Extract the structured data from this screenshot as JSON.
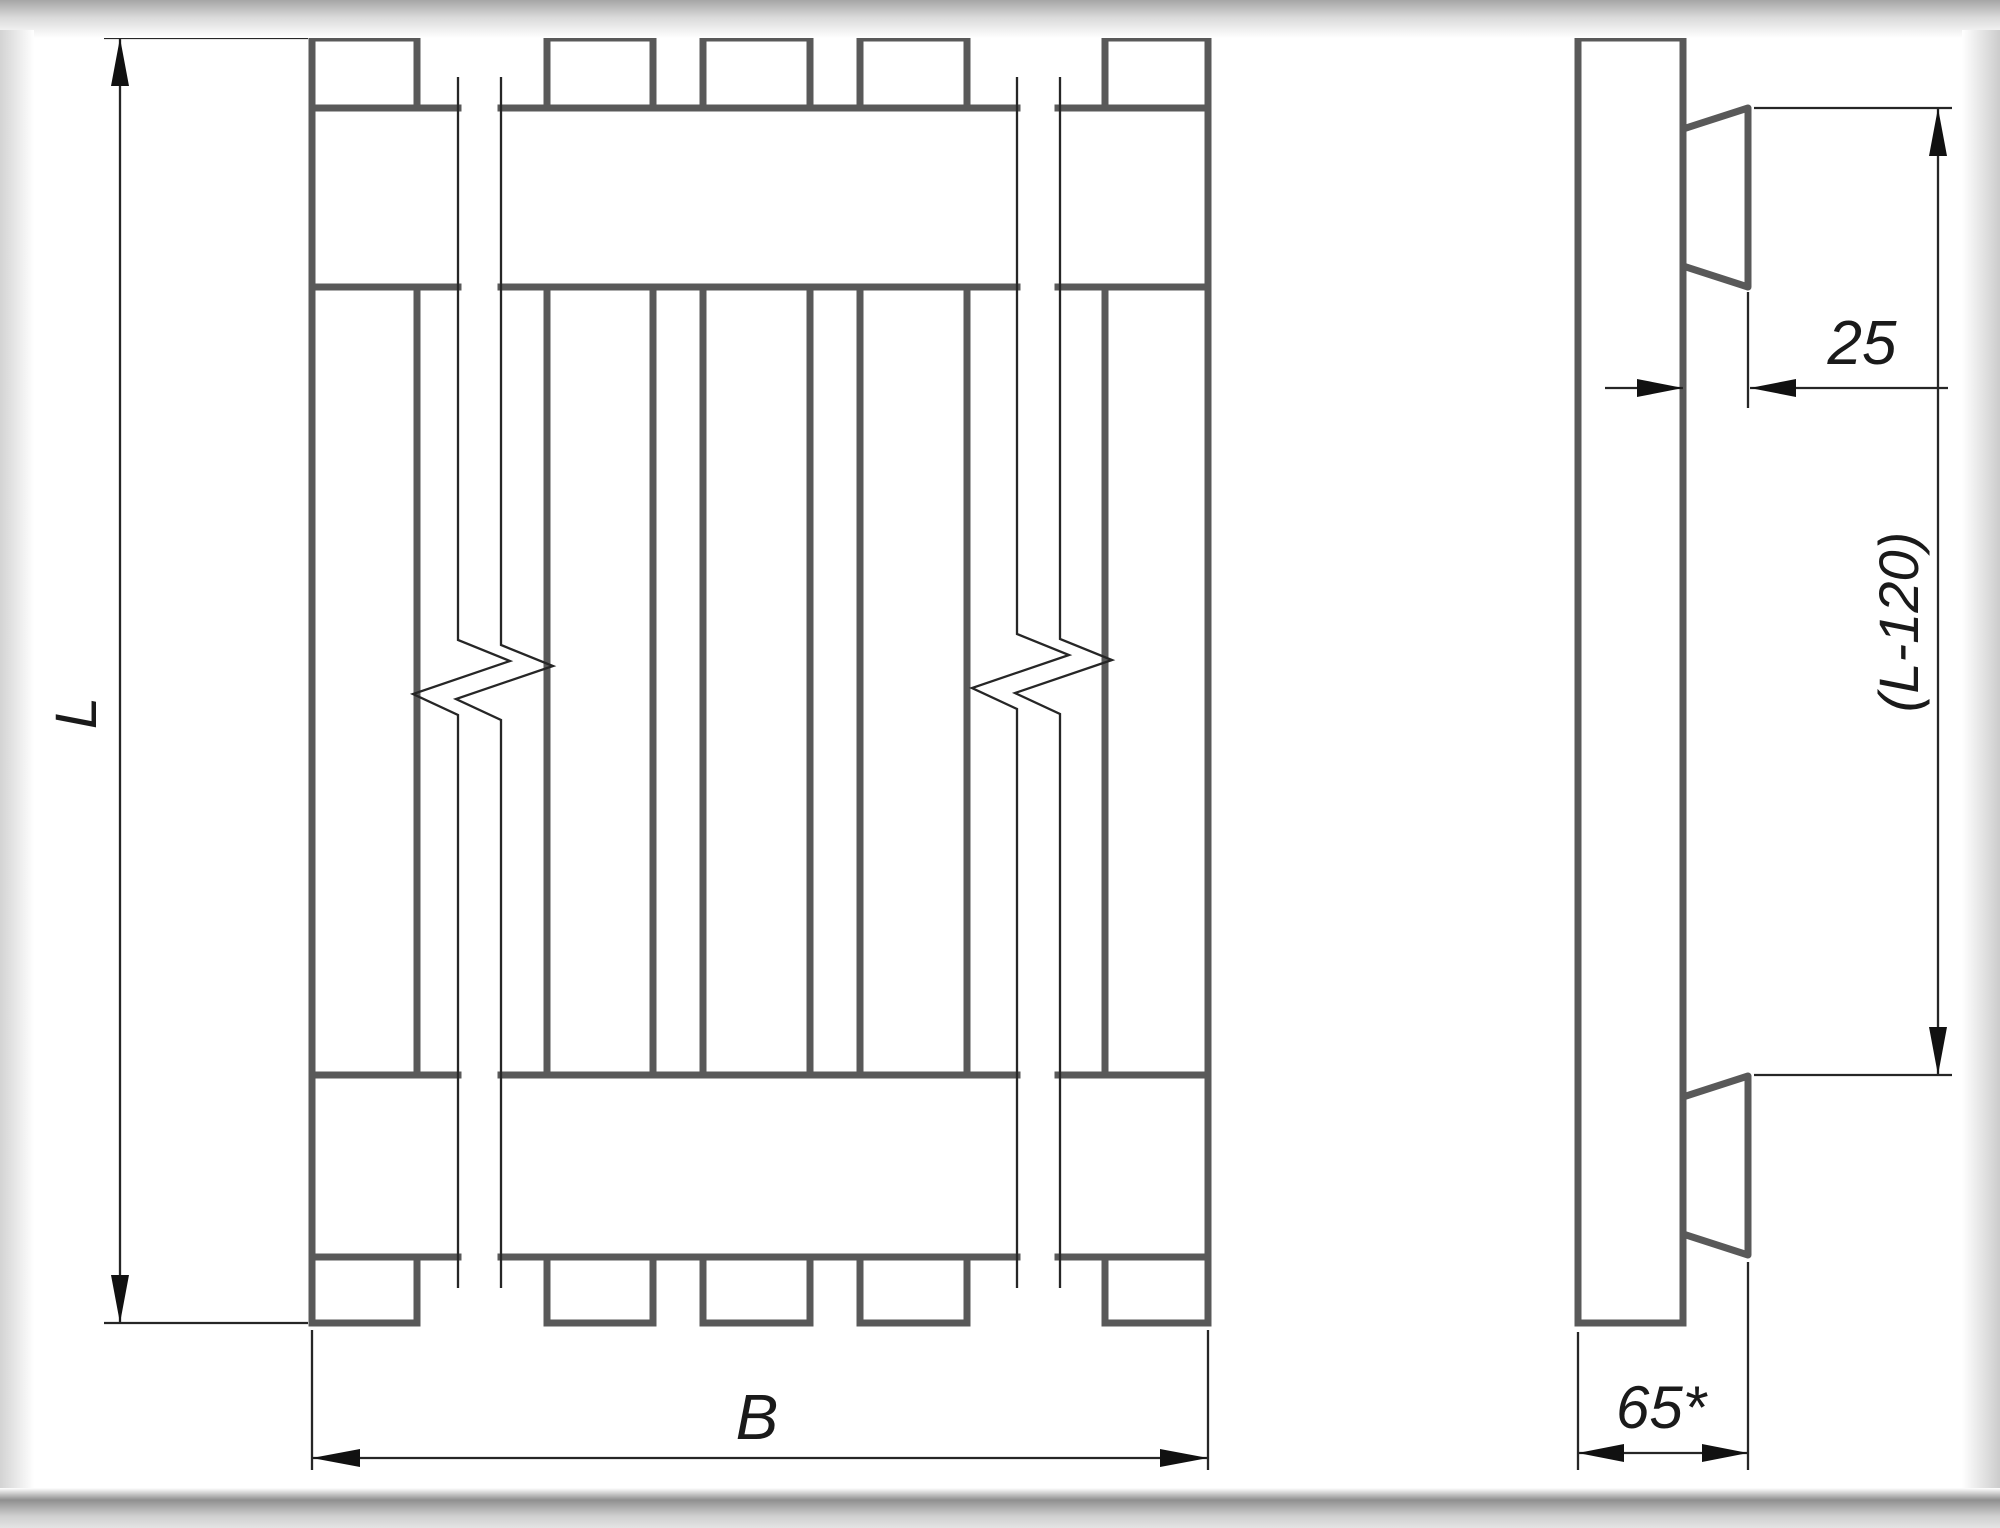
{
  "dimensions": {
    "length": "L",
    "width": "B",
    "batten_thickness": "25",
    "batten_inset_span": "(L-120)",
    "overall_thickness": "65*"
  },
  "colors": {
    "paper": "#ffffff",
    "thick_line": "#595959",
    "thin_line": "#262626",
    "text": "#1a1a1a"
  }
}
